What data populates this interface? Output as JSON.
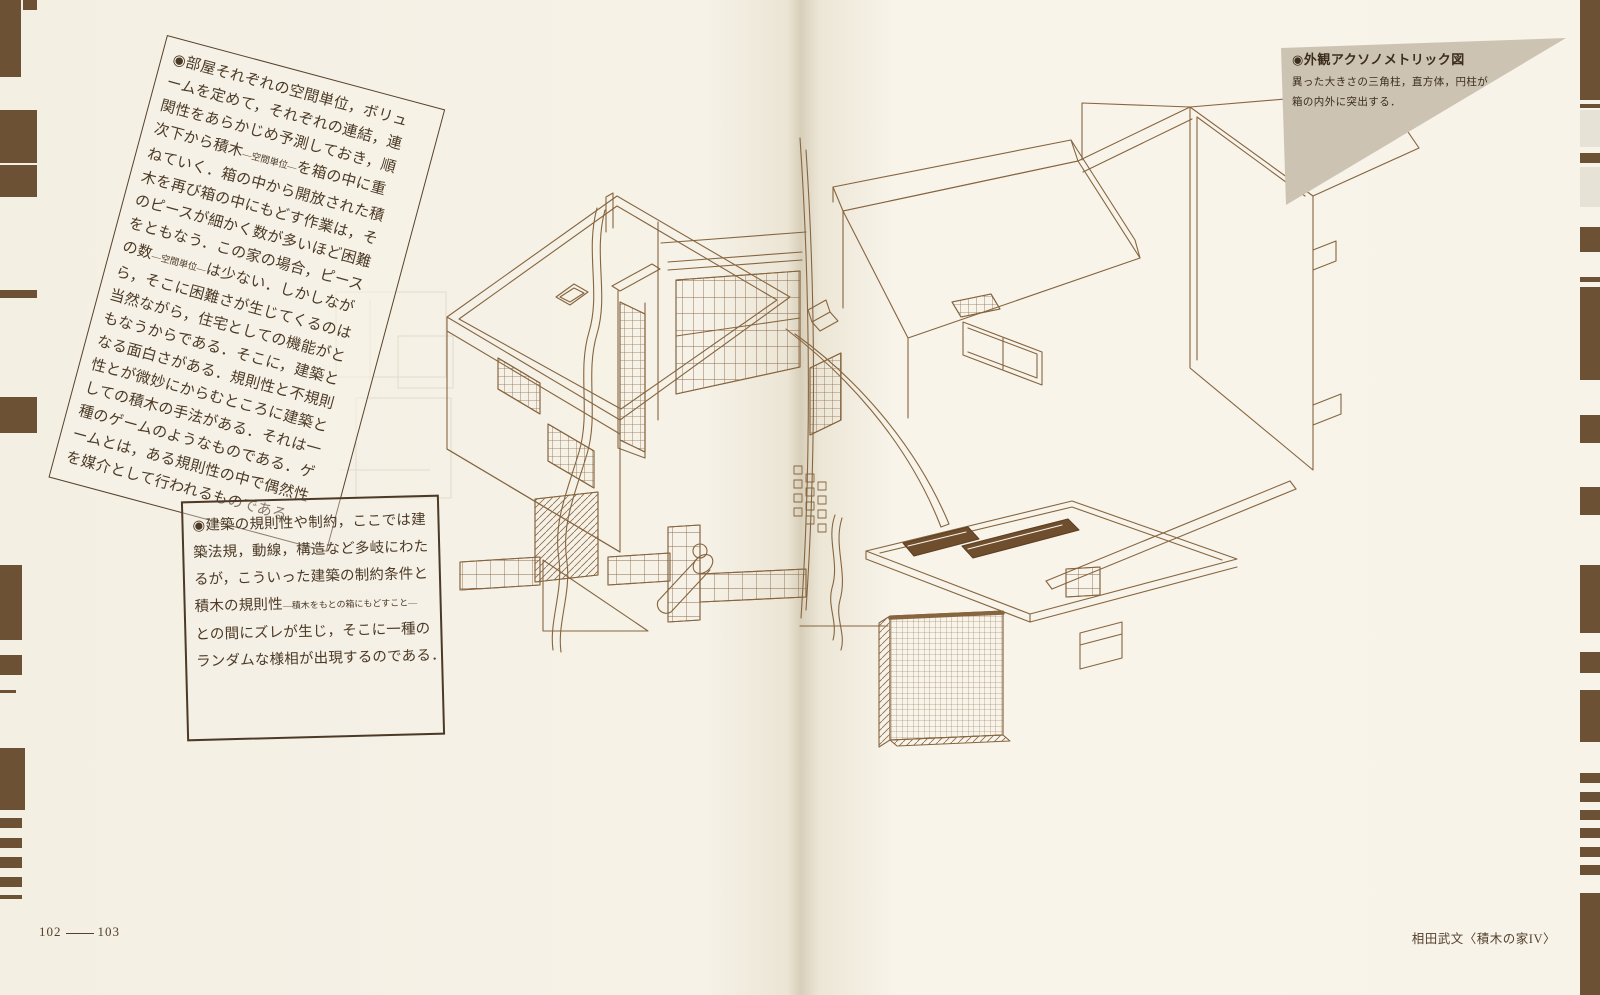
{
  "footer": {
    "folio_left": "102",
    "folio_right": "103",
    "credit": "相田武文〈積木の家IV〉"
  },
  "left_page": {
    "tilted_note": {
      "lines": [
        "◉部屋それぞれの空間単位，ボリュ",
        "ームを定めて，それぞれの連結，連",
        "関性をあらかじめ予測しておき，順",
        [
          {
            "t": "次下から積木"
          },
          {
            "t": "―空間単位―",
            "s": true
          },
          {
            "t": "を箱の中に重"
          }
        ],
        "ねていく．箱の中から開放された積",
        "木を再び箱の中にもどす作業は，そ",
        "のピースが細かく数が多いほど困難",
        "をともなう．この家の場合，ピース",
        [
          {
            "t": "の数"
          },
          {
            "t": "―空間単位―",
            "s": true
          },
          {
            "t": "は少ない．しかしなが"
          }
        ],
        "ら，そこに困難さが生じてくるのは",
        "当然ながら，住宅としての機能がと",
        "もなうからである．そこに，建築と",
        "なる面白さがある．規則性と不規則",
        "性とが微妙にからむところに建築と",
        "しての積木の手法がある．それは一",
        "種のゲームのようなものである．ゲ",
        "ームとは，ある規則性の中で偶然性",
        "を媒介として行われるものである．"
      ]
    },
    "boxed_note": {
      "lines": [
        "◉建築の規則性や制約，ここでは建",
        "築法規，動線，構造など多岐にわた",
        "るが，こういった建築の制約条件と",
        [
          {
            "t": "積木の規則性"
          },
          {
            "t": "―積木をもとの箱にもどすこと―",
            "s": true
          }
        ],
        "との間にズレが生じ，そこに一種の",
        "ランダムな様相が出現するのである．"
      ]
    }
  },
  "right_page": {
    "figure_caption": {
      "title": "◉外観アクソノメトリック図",
      "lines": [
        "異った大きさの三角柱，直方体，円柱が",
        "箱の内外に突出する．"
      ]
    }
  },
  "colors": {
    "paper": "#f6f2e8",
    "ink": "#4c3a26",
    "line_art": "#86653f",
    "triangle_fill": "#cdc3b3",
    "edge_stripe": "#6d5134"
  }
}
